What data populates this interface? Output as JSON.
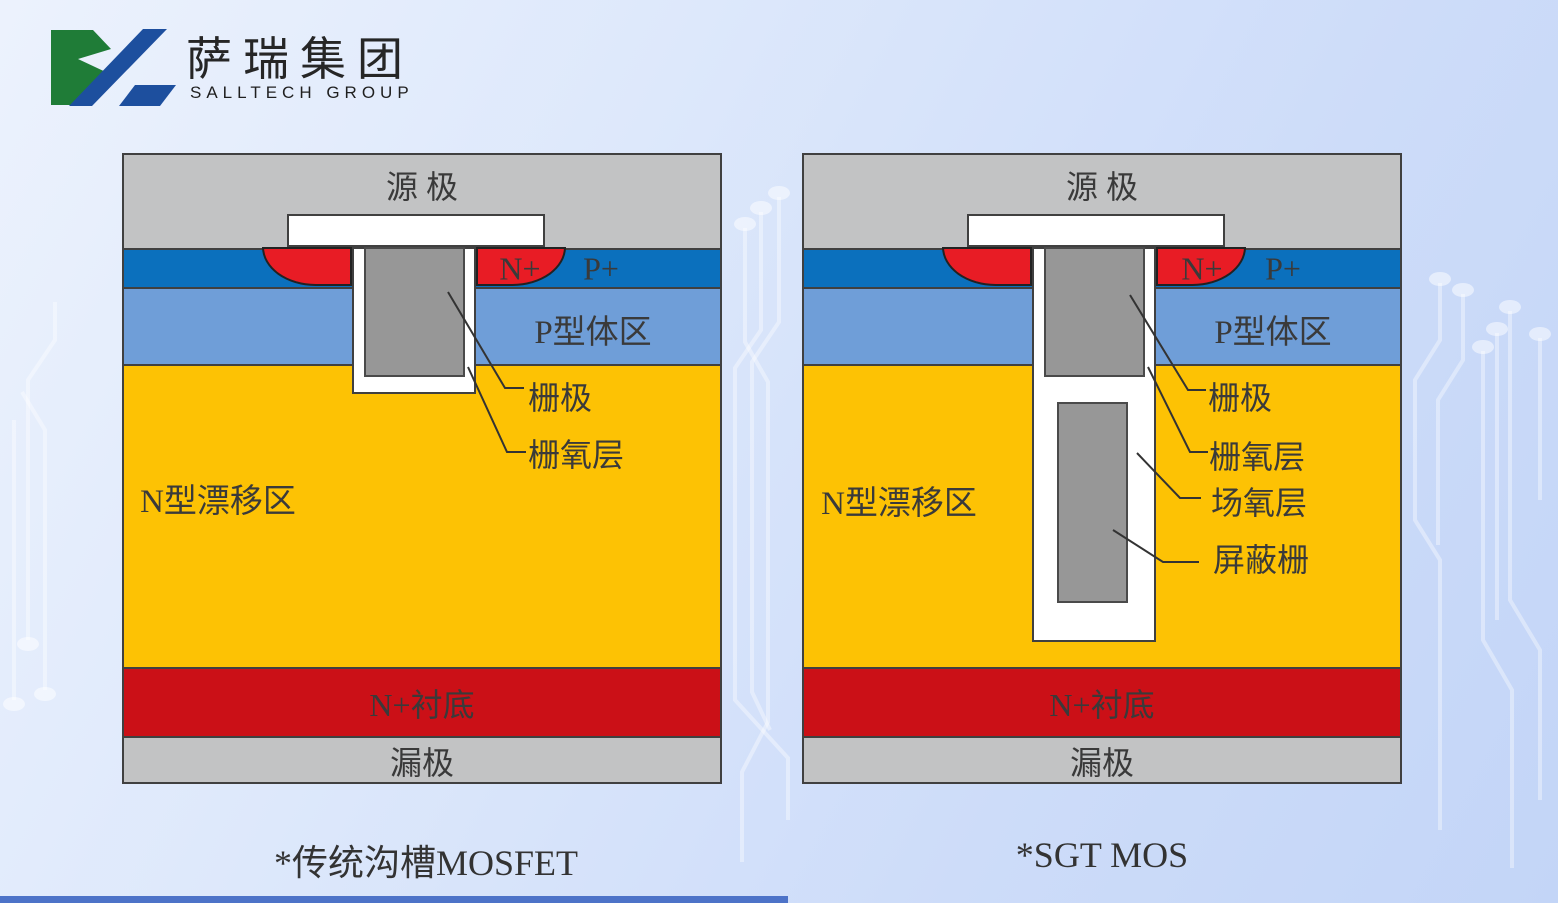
{
  "logo": {
    "brand_cn": "萨瑞集团",
    "brand_en": "SALLTECH GROUP",
    "icon_green": "#1f7c37",
    "icon_blue": "#1d4f9e"
  },
  "colors": {
    "metal_gray": "#c2c3c4",
    "source_layer_blue": "#0b70bd",
    "n_plus_pocket_red": "#e81c25",
    "p_body_blue": "#6f9ed8",
    "n_drift_yellow": "#fdc204",
    "substrate_red": "#cb1017",
    "gate_gray": "#979797",
    "outline": "#404040",
    "bottom_bar": "#4d73c8"
  },
  "diagrams": [
    {
      "caption": "*传统沟槽MOSFET",
      "labels": {
        "source": "源 极",
        "n_plus": "N+",
        "p_plus": "P+",
        "p_body": "P型体区",
        "n_drift": "N型漂移区",
        "gate": "栅极",
        "gate_oxide": "栅氧层",
        "substrate": "N+衬底",
        "drain": "漏极"
      }
    },
    {
      "caption": "*SGT MOS",
      "labels": {
        "source": "源 极",
        "n_plus": "N+",
        "p_plus": "P+",
        "p_body": "P型体区",
        "n_drift": "N型漂移区",
        "gate": "栅极",
        "gate_oxide": "栅氧层",
        "field_oxide": "场氧层",
        "shield_gate": "屏蔽栅",
        "substrate": "N+衬底",
        "drain": "漏极"
      }
    }
  ]
}
